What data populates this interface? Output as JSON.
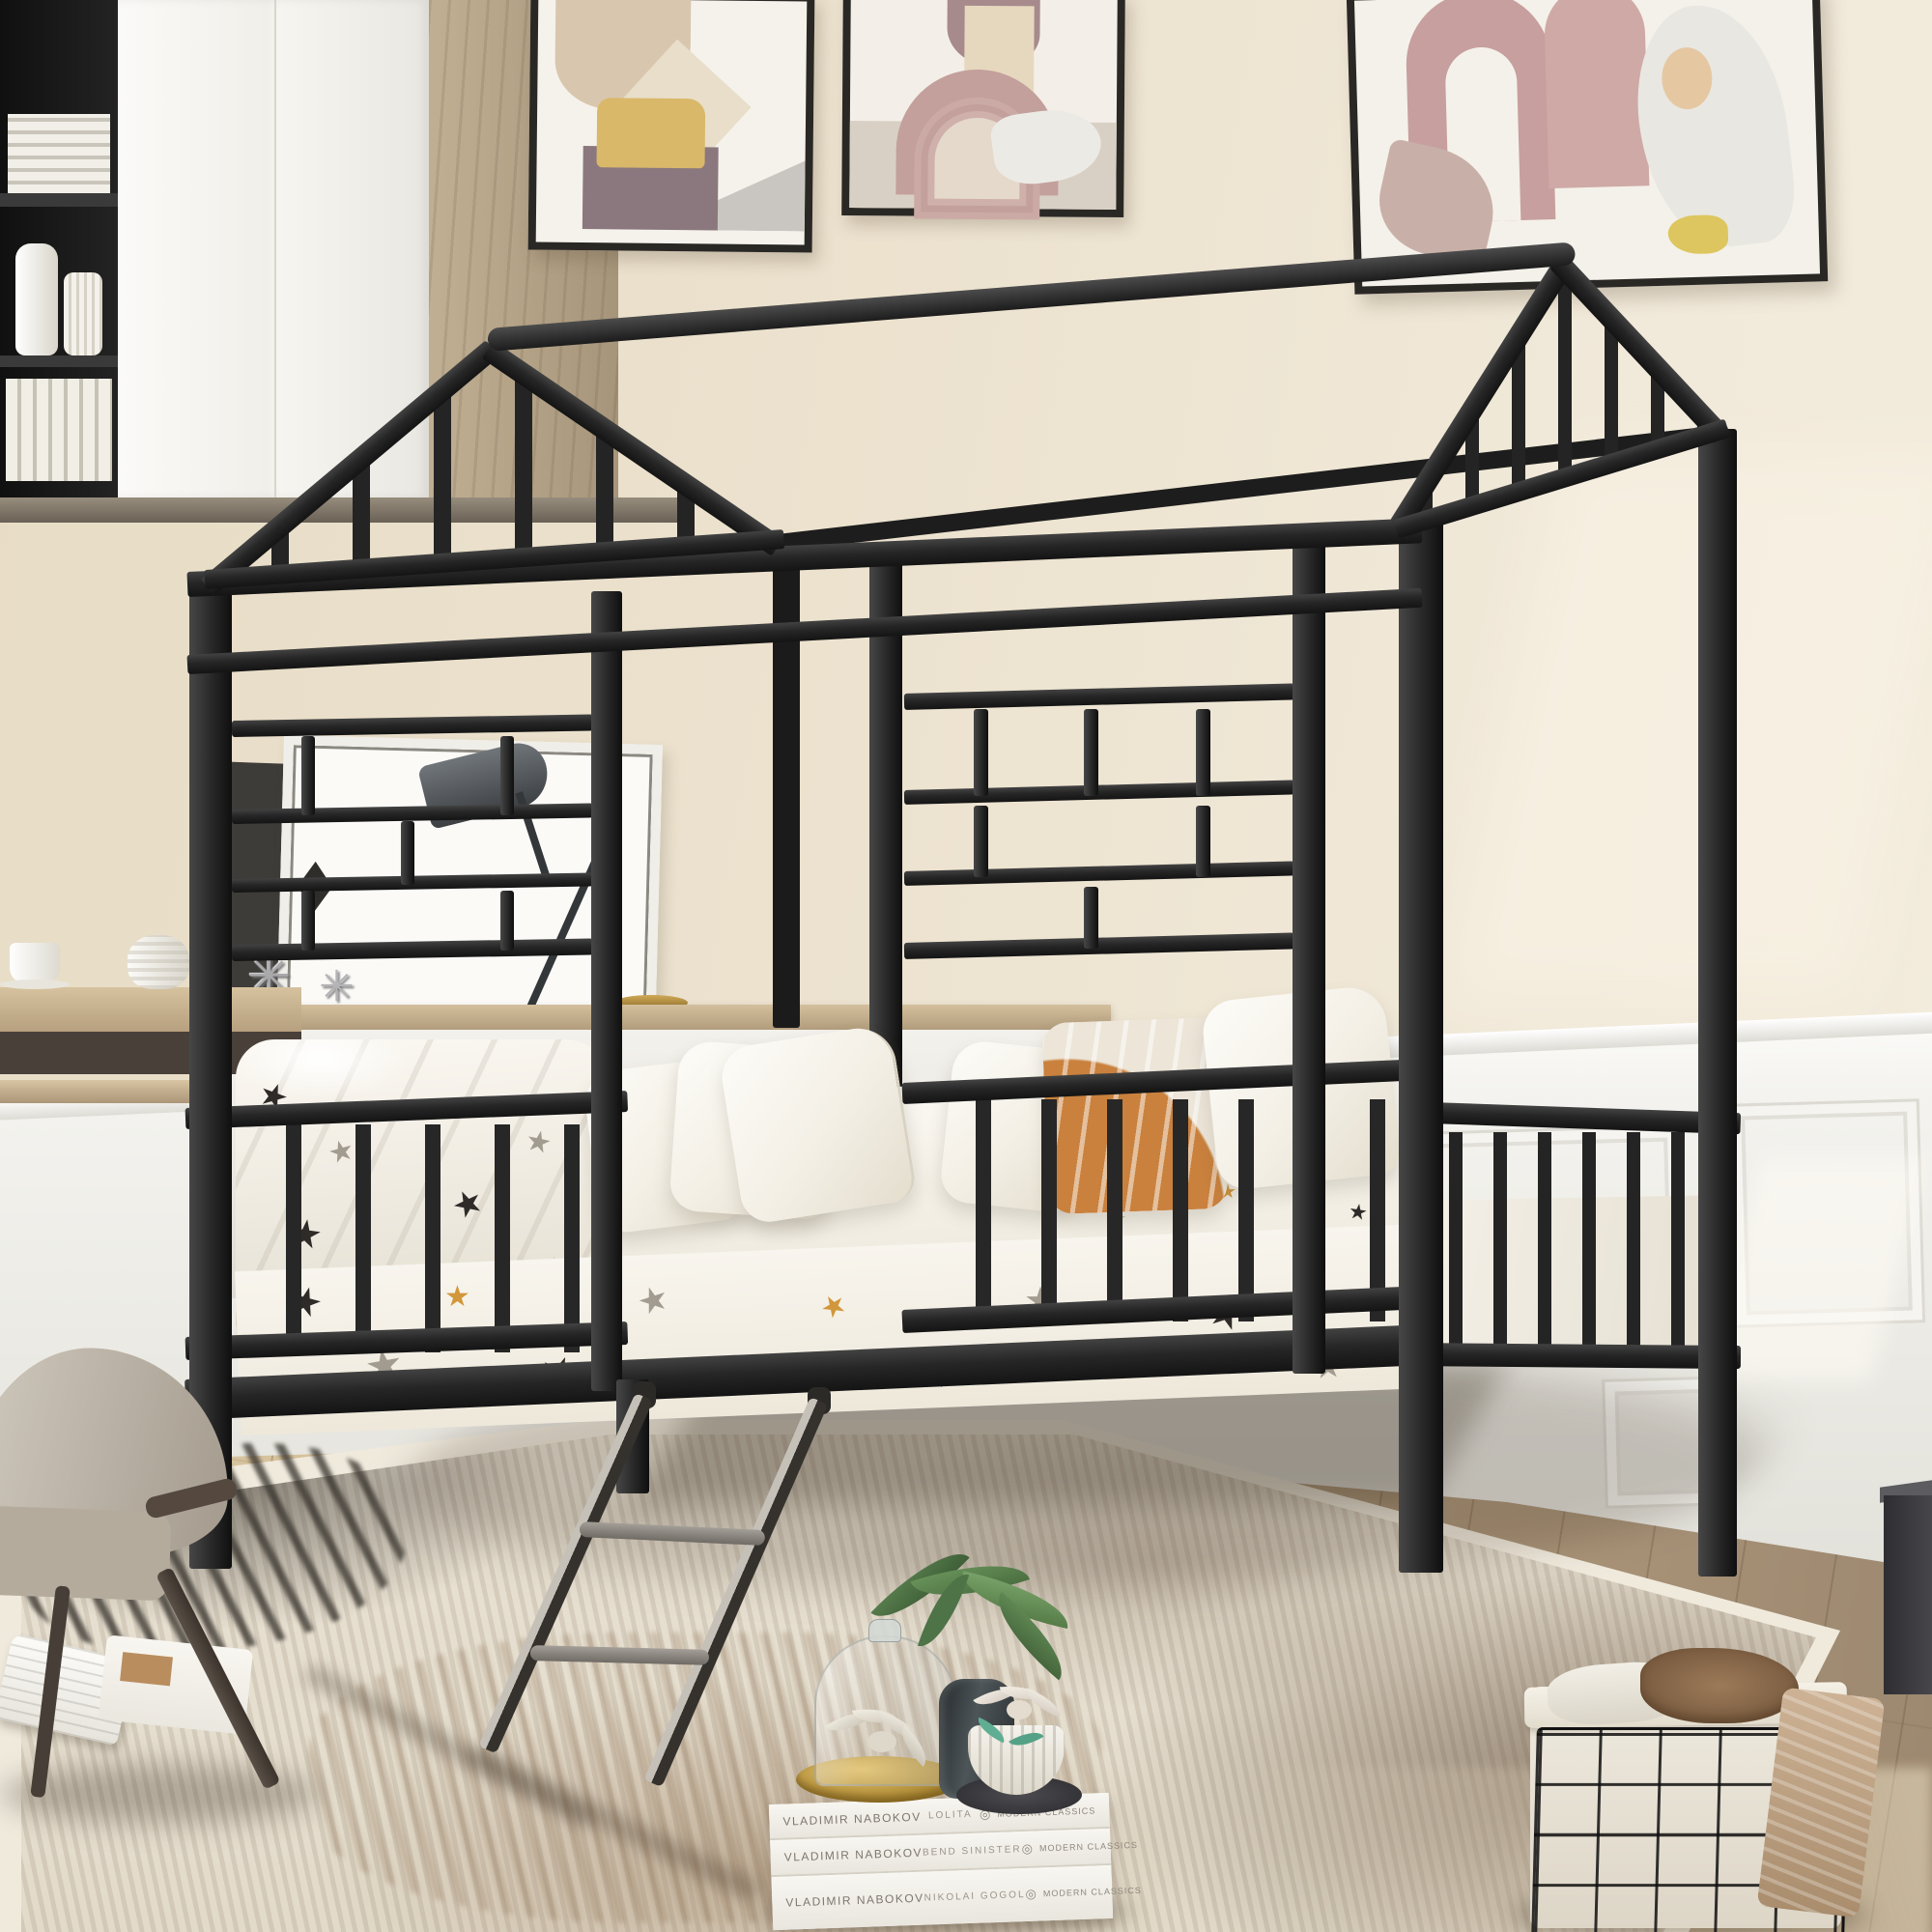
{
  "scene": {
    "description": "Lifestyle product photo: black metal kids house-frame day bed with roof ridge pole, gable ends, window-grid panels, slatted guardrails and a leaning metal ladder, staged in a beige bedroom with white wainscoting, three abstract art prints, wood-and-white cabinetry, desk nook with gray chair, star-print bedding, patterned rug, book stack with plants and a wire storage basket."
  },
  "palette": {
    "wall": "#ece2cf",
    "wainscot": "#f3f2ee",
    "floor_light": "#dcc9a4",
    "floor_dark": "#9c8870",
    "metal_black": "#262626",
    "bedding_white": "#f6f3ec",
    "star_black": "#2e2b28",
    "star_gray": "#a29c90",
    "star_orange": "#d2973b",
    "pillow_orange": "#c9813d",
    "wood": "#cbb392",
    "rug_cream": "#e7e0d1",
    "gold_tray": "#c9a344",
    "ladder_rung_gray": "#8d8883",
    "plant_green": "#5f8457"
  },
  "glyphs": {
    "star": "★",
    "jack": "✳",
    "logo": "◎"
  },
  "books_stack": {
    "spines": [
      {
        "author": "VLADIMIR NABOKOV",
        "title": "LOLITA",
        "publisher": "MODERN CLASSICS"
      },
      {
        "author": "VLADIMIR NABOKOV",
        "title": "BEND SINISTER",
        "publisher": "MODERN CLASSICS"
      },
      {
        "author": "VLADIMIR NABOKOV",
        "title": "NIKOLAI GOGOL",
        "publisher": "MODERN CLASSICS"
      }
    ]
  }
}
